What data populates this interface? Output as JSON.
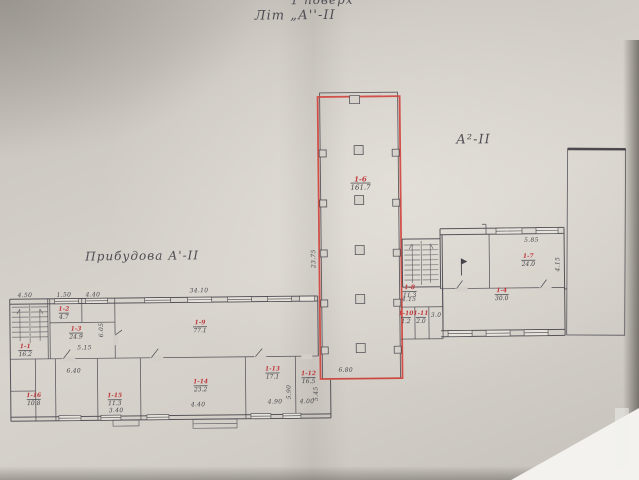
{
  "titles": {
    "floor": "1 поверх",
    "lit": "Літ „А''-ІІ",
    "wing": "А²-ІІ",
    "annex": "Прибудова А'-ІІ"
  },
  "colors": {
    "highlight_red": "#d0453f",
    "room_number_red": "#bf3a3e",
    "ink": "#45424a",
    "paper": "#d2cec7"
  },
  "rooms": [
    {
      "id": "1-1",
      "area": "16.2"
    },
    {
      "id": "1-2",
      "area": "4.7"
    },
    {
      "id": "1-3",
      "area": "24.9"
    },
    {
      "id": "1-9",
      "area": "77.1"
    },
    {
      "id": "1-16",
      "area": "10.8"
    },
    {
      "id": "1-15",
      "area": "11.3"
    },
    {
      "id": "1-14",
      "area": "23.2"
    },
    {
      "id": "1-13",
      "area": "17.1"
    },
    {
      "id": "1-12",
      "area": "16.5"
    },
    {
      "id": "1-6",
      "area": "161.7"
    },
    {
      "id": "1-8",
      "area": "11.3"
    },
    {
      "id": "1-10",
      "area": "1.2"
    },
    {
      "id": "1-11",
      "area": "2.0"
    },
    {
      "id": "1-4",
      "area": "30.0"
    },
    {
      "id": "1-7",
      "area": "24.0"
    }
  ],
  "dims": [
    "34.10",
    "4.50",
    "1.50",
    "4.40",
    "6.05",
    "5.15",
    "6.40",
    "3.40",
    "4.40",
    "4.90",
    "4.00",
    "5.90",
    "5.45",
    "23.75",
    "6.80",
    "4.15",
    "5.85",
    "4.15",
    "3.0"
  ]
}
